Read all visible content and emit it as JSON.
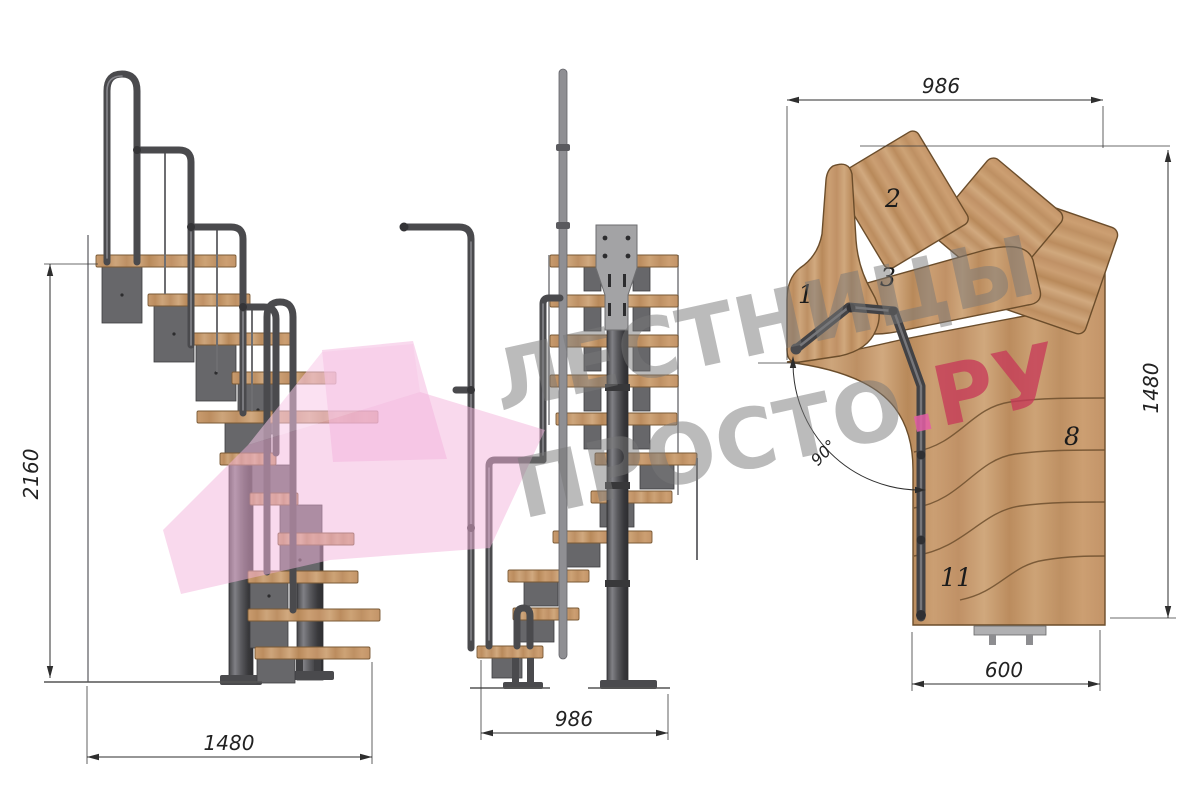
{
  "watermark": {
    "line1": "ЛЕСТНИЦЫ",
    "line2_main": "ПРОСТО",
    "line2_dot": ".",
    "line2_accent": "РУ"
  },
  "side_view": {
    "dim_height": "2160",
    "dim_width": "1480"
  },
  "front_view": {
    "dim_width": "986"
  },
  "plan_view": {
    "dim_top": "986",
    "dim_right": "1480",
    "dim_bottom": "600",
    "angle": "90°",
    "step_labels": {
      "s1": "1",
      "s2": "2",
      "s3": "3",
      "s8": "8",
      "s11": "11"
    }
  },
  "colors": {
    "wood": "#c69a6e",
    "wood_outline": "#6b4d2b",
    "metal": "#58585a",
    "metal_dark": "#3a3a3d",
    "dim_line": "#2e2e2e",
    "watermark_gray": "#787878",
    "watermark_red": "#c63a58",
    "watermark_pink_dot": "#e45ea6",
    "logo_pink": "#f3b3dc"
  }
}
